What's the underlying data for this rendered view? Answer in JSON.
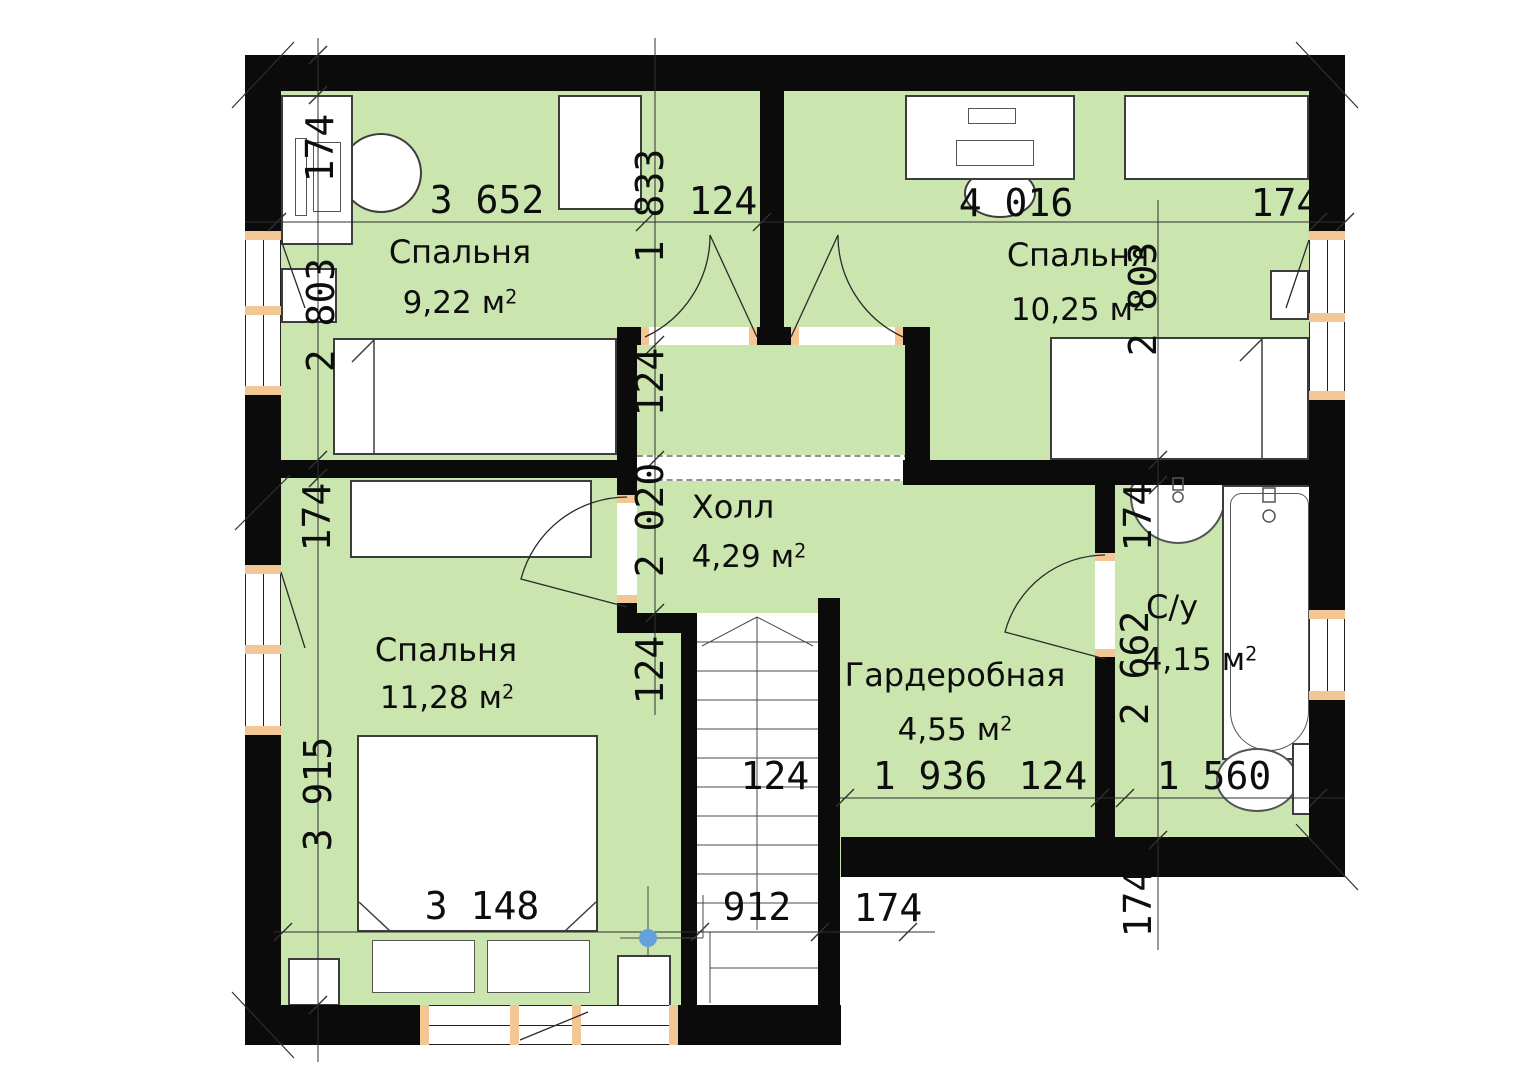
{
  "title": "Поэтажный план — 2 этаж",
  "colors": {
    "floor": "#cbe5af",
    "wall": "#0b0b0b",
    "jamb": "#f3c696",
    "marker_blue": "#64a0dc"
  },
  "rooms": {
    "bedroom_tl": {
      "label": "Спальня",
      "area": "9,22",
      "unit": "м",
      "sup": "2"
    },
    "bedroom_tr": {
      "label": "Спальня",
      "area": "10,25",
      "unit": "м",
      "sup": "2"
    },
    "hall": {
      "label": "Холл",
      "area": "4,29",
      "unit": "м",
      "sup": "2"
    },
    "bedroom_bl": {
      "label": "Спальня",
      "area": "11,28",
      "unit": "м",
      "sup": "2"
    },
    "wardrobe": {
      "label": "Гардеробная",
      "area": "4,55",
      "unit": "м",
      "sup": "2"
    },
    "bathroom": {
      "label": "С/у",
      "area": "4,15",
      "unit": "м",
      "sup": "2"
    }
  },
  "dims": {
    "d174_tl": "174",
    "d3652": "3 652",
    "d1833": "1 833",
    "d124_top": "124",
    "d4016": "4 016",
    "d174_tr": "174",
    "d2803_l": "2 803",
    "d2803_r": "2 803",
    "d124_hall_u": "124",
    "d2020": "2 020",
    "d174_lm": "174",
    "d124_hall_l": "124",
    "d3915": "3 915",
    "d174_bath": "174",
    "d2662": "2 662",
    "d124_stairs": "124",
    "d1936": "1 936",
    "d124_gard": "124",
    "d1560": "1 560",
    "d3148": "3 148",
    "d912": "912",
    "d174_bm": "174",
    "d174_br": "174"
  }
}
